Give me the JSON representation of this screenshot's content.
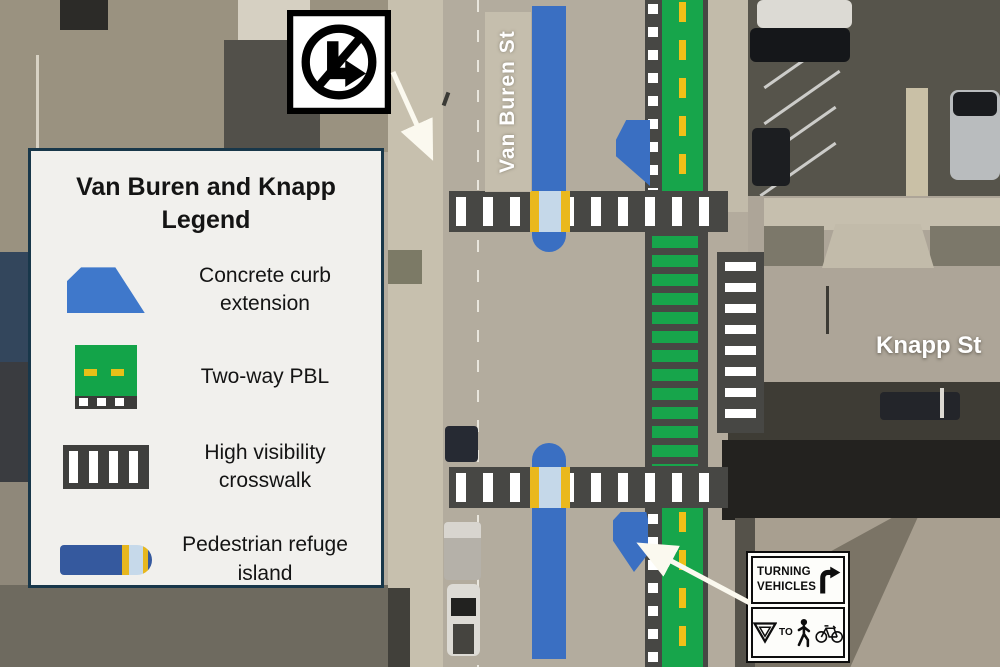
{
  "map": {
    "street_labels": {
      "van_buren": "Van Buren St",
      "knapp": "Knapp St"
    }
  },
  "legend": {
    "title_line1": "Van Buren and Knapp",
    "title_line2": "Legend",
    "items": [
      {
        "icon": "curb-extension-icon",
        "label": "Concrete curb extension"
      },
      {
        "icon": "two-way-pbl-icon",
        "label": "Two-way PBL"
      },
      {
        "icon": "high-visibility-crosswalk-icon",
        "label": "High visibility crosswalk"
      },
      {
        "icon": "pedestrian-refuge-island-icon",
        "label": "Pedestrian refuge island"
      }
    ]
  },
  "signs": {
    "no_right_turn": {
      "name": "no-right-turn-sign"
    },
    "turning_vehicles": {
      "line1": "TURNING",
      "line2": "VEHICLES",
      "to_label": "TO",
      "symbols": [
        "yield-icon",
        "pedestrian-icon",
        "bicycle-icon"
      ]
    }
  },
  "colors": {
    "pbl_green": "#17a54b",
    "lane_dash_yellow": "#f0c018",
    "curb_blue": "#3a6fc2",
    "crosswalk_dark": "#474744",
    "refuge_cut_blue": "#c5d8e9",
    "legend_border": "#18374a",
    "legend_bg": "#f1f0ed"
  }
}
